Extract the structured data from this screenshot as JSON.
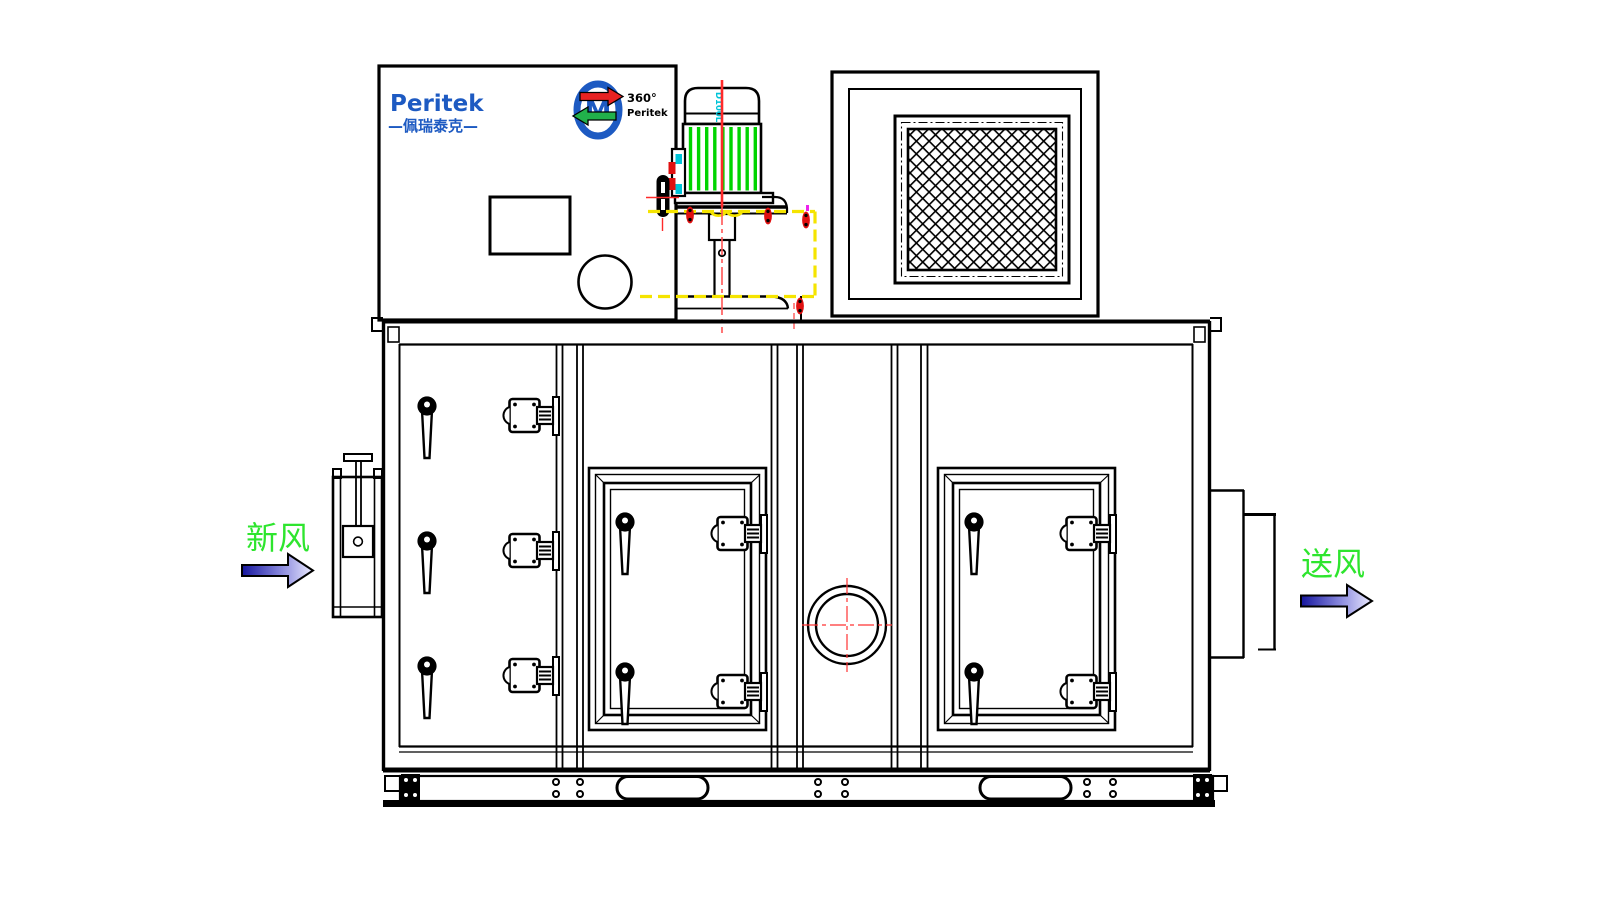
{
  "labels": {
    "brand": "Peritek",
    "brand_cn": "—佩瑞泰克—",
    "rotor_badge_top": "360°",
    "rotor_badge_bottom": "Peritek",
    "rotor_monogram": "M",
    "motor_model": "D100L",
    "fresh_air": "新风",
    "supply_air": "送风"
  },
  "colors": {
    "line_black": "#000000",
    "brand_blue": "#1d5ac2",
    "label_green": "#2ee52e",
    "fin_green": "#00d400",
    "centerline_red": "#ff2a2a",
    "soft_red": "#ff5555",
    "bolt_red": "#e01010",
    "hidden_yellow": "#f5e400",
    "accent_cyan": "#00c4d8",
    "accent_magenta": "#ee22ee",
    "logo_arrow_red": "#e82222",
    "logo_arrow_green": "#21b14b",
    "arrow_dark": "#16169e",
    "arrow_light": "#ececff"
  },
  "components": [
    "control-box",
    "drive-motor",
    "filter-grille-box",
    "main-cabinet",
    "left-access-panel",
    "inspection-door-1",
    "inspection-door-2",
    "sight-glass",
    "fresh-air-damper",
    "supply-air-flange",
    "base-frame"
  ]
}
